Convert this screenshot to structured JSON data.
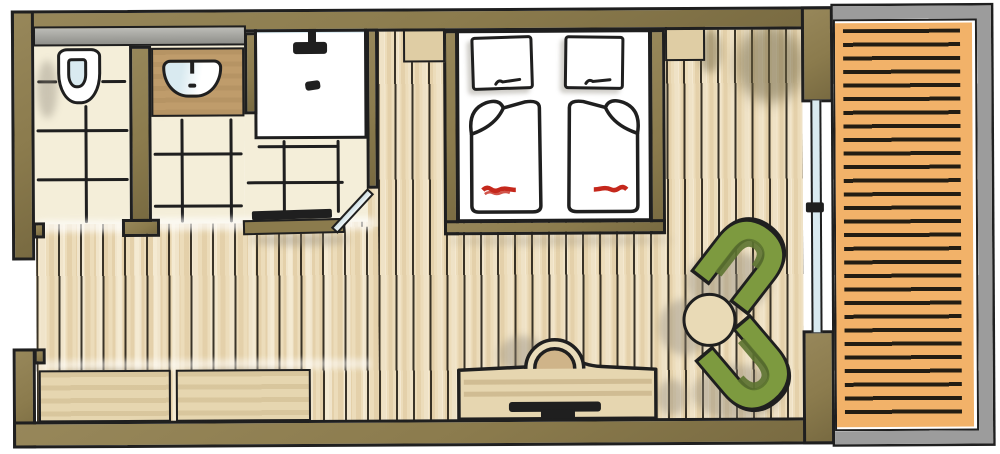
{
  "meta": {
    "title": "Hotel room floor plan - hand-drawn marker sketch, top-down view",
    "type": "floor-plan",
    "text_on_image": "none"
  },
  "colors": {
    "ink": "#1f1f1f",
    "wall": "#8b7b4d",
    "wallDark": "#6b6140",
    "tile": "#f4eed9",
    "plank": "#ecdcba",
    "vanity": "#bf9c6b",
    "mirror": "#a6a6a1",
    "glassBlue": "#d9eaf0",
    "bedWhite": "#ffffff",
    "bedRed": "#c5281c",
    "nightstand": "#dfcda4",
    "wood": "#e6d6b0",
    "woodDark": "#cfb489",
    "deck": "#f2b269",
    "deckLine": "#231d13",
    "railGray": "#9c9c9c",
    "chairGreen": "#7d9a3f",
    "chairGreenDark": "#5c7330",
    "tableCream": "#e9dab6",
    "shadow": "#8d8679"
  },
  "rooms": {
    "wc": "toilet compartment",
    "bath": "bathroom with shower and vanity",
    "bedroom": "main bedroom area",
    "balcony": "balcony with wood decking"
  },
  "objects": {
    "toilet": "wall-hung toilet",
    "sink": "washbasin on vanity counter",
    "mirror": "mirror strip above vanity",
    "shower": "walk-in shower",
    "shower_head": "rain shower head",
    "drain": "shower floor drain",
    "bath_door": "open bathroom door leaf",
    "bench": "bench step at bathroom edge",
    "bed": "double bed",
    "pillow": "pillow",
    "duvet": "folded duvet with red stitching",
    "nightstand": "nightstand",
    "desk": "desk / TV board",
    "tv": "television on desk",
    "desk_chair": "desk chair",
    "sideboard": "low sideboard",
    "armchair": "green lounge chair",
    "side_table": "round side table",
    "balcony_door": "sliding glass balcony door",
    "deck": "balcony decking boards",
    "entry": "entry door opening"
  }
}
